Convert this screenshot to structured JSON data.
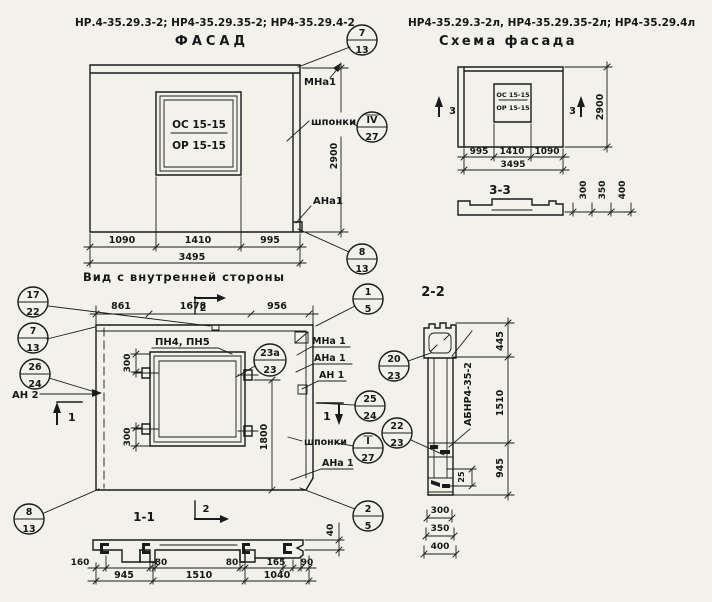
{
  "titles": {
    "facade_codes": "НР.4-35.29.3-2; НР4-35.29.35-2; НР4-35.29.4-2",
    "facade": "ФАСАД",
    "schema_codes": "НР4-35.29.3-2л, НР4-35.29.35-2л; НР4-35.29.4л",
    "schema": "Схема фасада",
    "inner_view": "Вид с внутренней стороны",
    "s11": "1-1",
    "s22": "2-2",
    "s33": "3-3"
  },
  "facade": {
    "mark_top": "ОС 15-15",
    "mark_bot": "ОР 15-15",
    "d1": "1090",
    "d2": "1410",
    "d3": "995",
    "total": "3495",
    "h": "2900",
    "mna1": "МНа1",
    "shponki": "шпонки",
    "ana1": "АНа1"
  },
  "schema": {
    "mark_top": "ОС 15-15",
    "mark_bot": "ОР 15-15",
    "d1": "995",
    "d2": "1410",
    "d3": "1090",
    "total": "3495",
    "h": "2900",
    "sec_l": "3",
    "sec_r": "3",
    "t300": "300",
    "t350": "350",
    "t400": "400"
  },
  "inner": {
    "d861": "861",
    "d1678": "1678",
    "d956": "956",
    "d300a": "300",
    "d300b": "300",
    "d1800": "1800",
    "pn": "ПН4, ПН5",
    "mna1": "МНа 1",
    "ana1a": "АНа 1",
    "an1": "АН 1",
    "an2": "АН 2",
    "shponki": "шпонки",
    "ana1b": "АНа 1",
    "m1a": "1",
    "m1b": "1",
    "m2a": "2",
    "m2b": "2"
  },
  "s11": {
    "d160": "160",
    "d80a": "80",
    "d80b": "80",
    "d165": "165",
    "d90": "90",
    "d945": "945",
    "d1510": "1510",
    "d1040": "1040",
    "d40": "40"
  },
  "s22": {
    "part": "АБНР4-35-2",
    "d445": "445",
    "d1510": "1510",
    "d945": "945",
    "d25": "25",
    "d300": "300",
    "d350": "350",
    "d400": "400"
  },
  "callouts": {
    "fc7": {
      "t": "7",
      "b": "13"
    },
    "fc4_27": {
      "t": "IV",
      "b": "27"
    },
    "fc8": {
      "t": "8",
      "b": "13"
    },
    "c17_22": {
      "t": "17",
      "b": "22"
    },
    "c7_13": {
      "t": "7",
      "b": "13"
    },
    "c26_24": {
      "t": "26",
      "b": "24"
    },
    "c1_5": {
      "t": "1",
      "b": "5"
    },
    "c23a": {
      "t": "23а",
      "b": "23"
    },
    "c25_24": {
      "t": "25",
      "b": "24"
    },
    "c20_23": {
      "t": "20",
      "b": "23"
    },
    "c22_23": {
      "t": "22",
      "b": "23"
    },
    "c1_27": {
      "t": "I",
      "b": "27"
    },
    "c2_5": {
      "t": "2",
      "b": "5"
    },
    "c8_13": {
      "t": "8",
      "b": "13"
    }
  }
}
